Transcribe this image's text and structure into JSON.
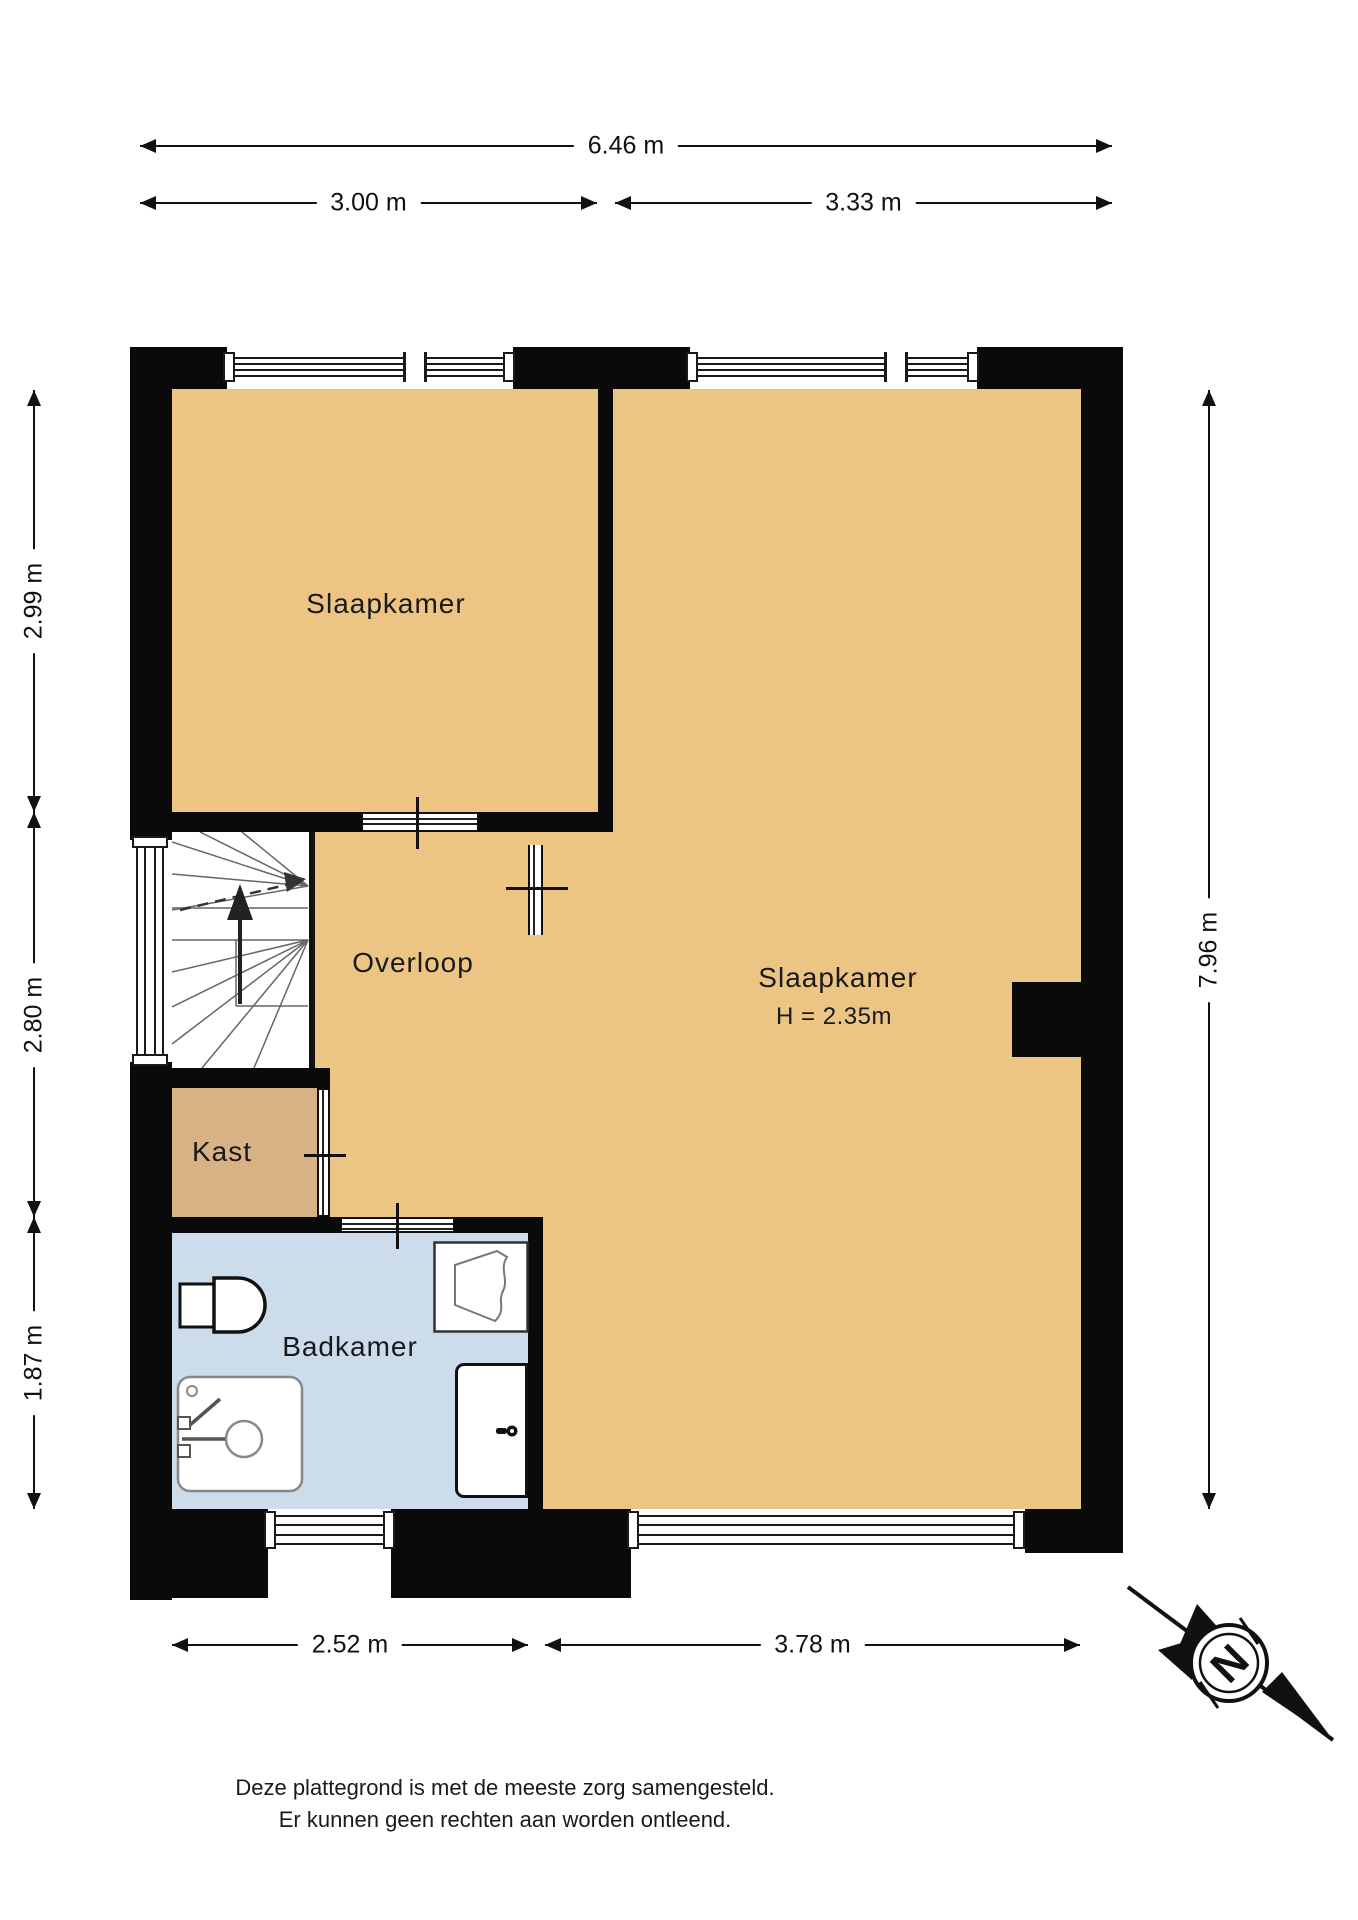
{
  "colors": {
    "wall": "#0a0a0a",
    "floor": "#ECC484",
    "closet": "#D6B284",
    "bath": "#CDDCEB"
  },
  "dimensions": {
    "top_total": "6.46 m",
    "top_left": "3.00 m",
    "top_right": "3.33 m",
    "left_top": "2.99 m",
    "left_middle": "2.80 m",
    "left_bottom": "1.87 m",
    "right_total": "7.96 m",
    "bottom_left": "2.52 m",
    "bottom_right": "3.78 m"
  },
  "rooms": {
    "bedroom_small": {
      "label": "Slaapkamer"
    },
    "bedroom_large": {
      "label": "Slaapkamer",
      "height_note": "H = 2.35m"
    },
    "landing": {
      "label": "Overloop"
    },
    "closet": {
      "label": "Kast"
    },
    "bathroom": {
      "label": "Badkamer"
    }
  },
  "compass": {
    "north_label": "N"
  },
  "disclaimer": {
    "line1": "Deze plattegrond is met de meeste zorg samengesteld.",
    "line2": "Er kunnen geen rechten aan worden ontleend."
  }
}
